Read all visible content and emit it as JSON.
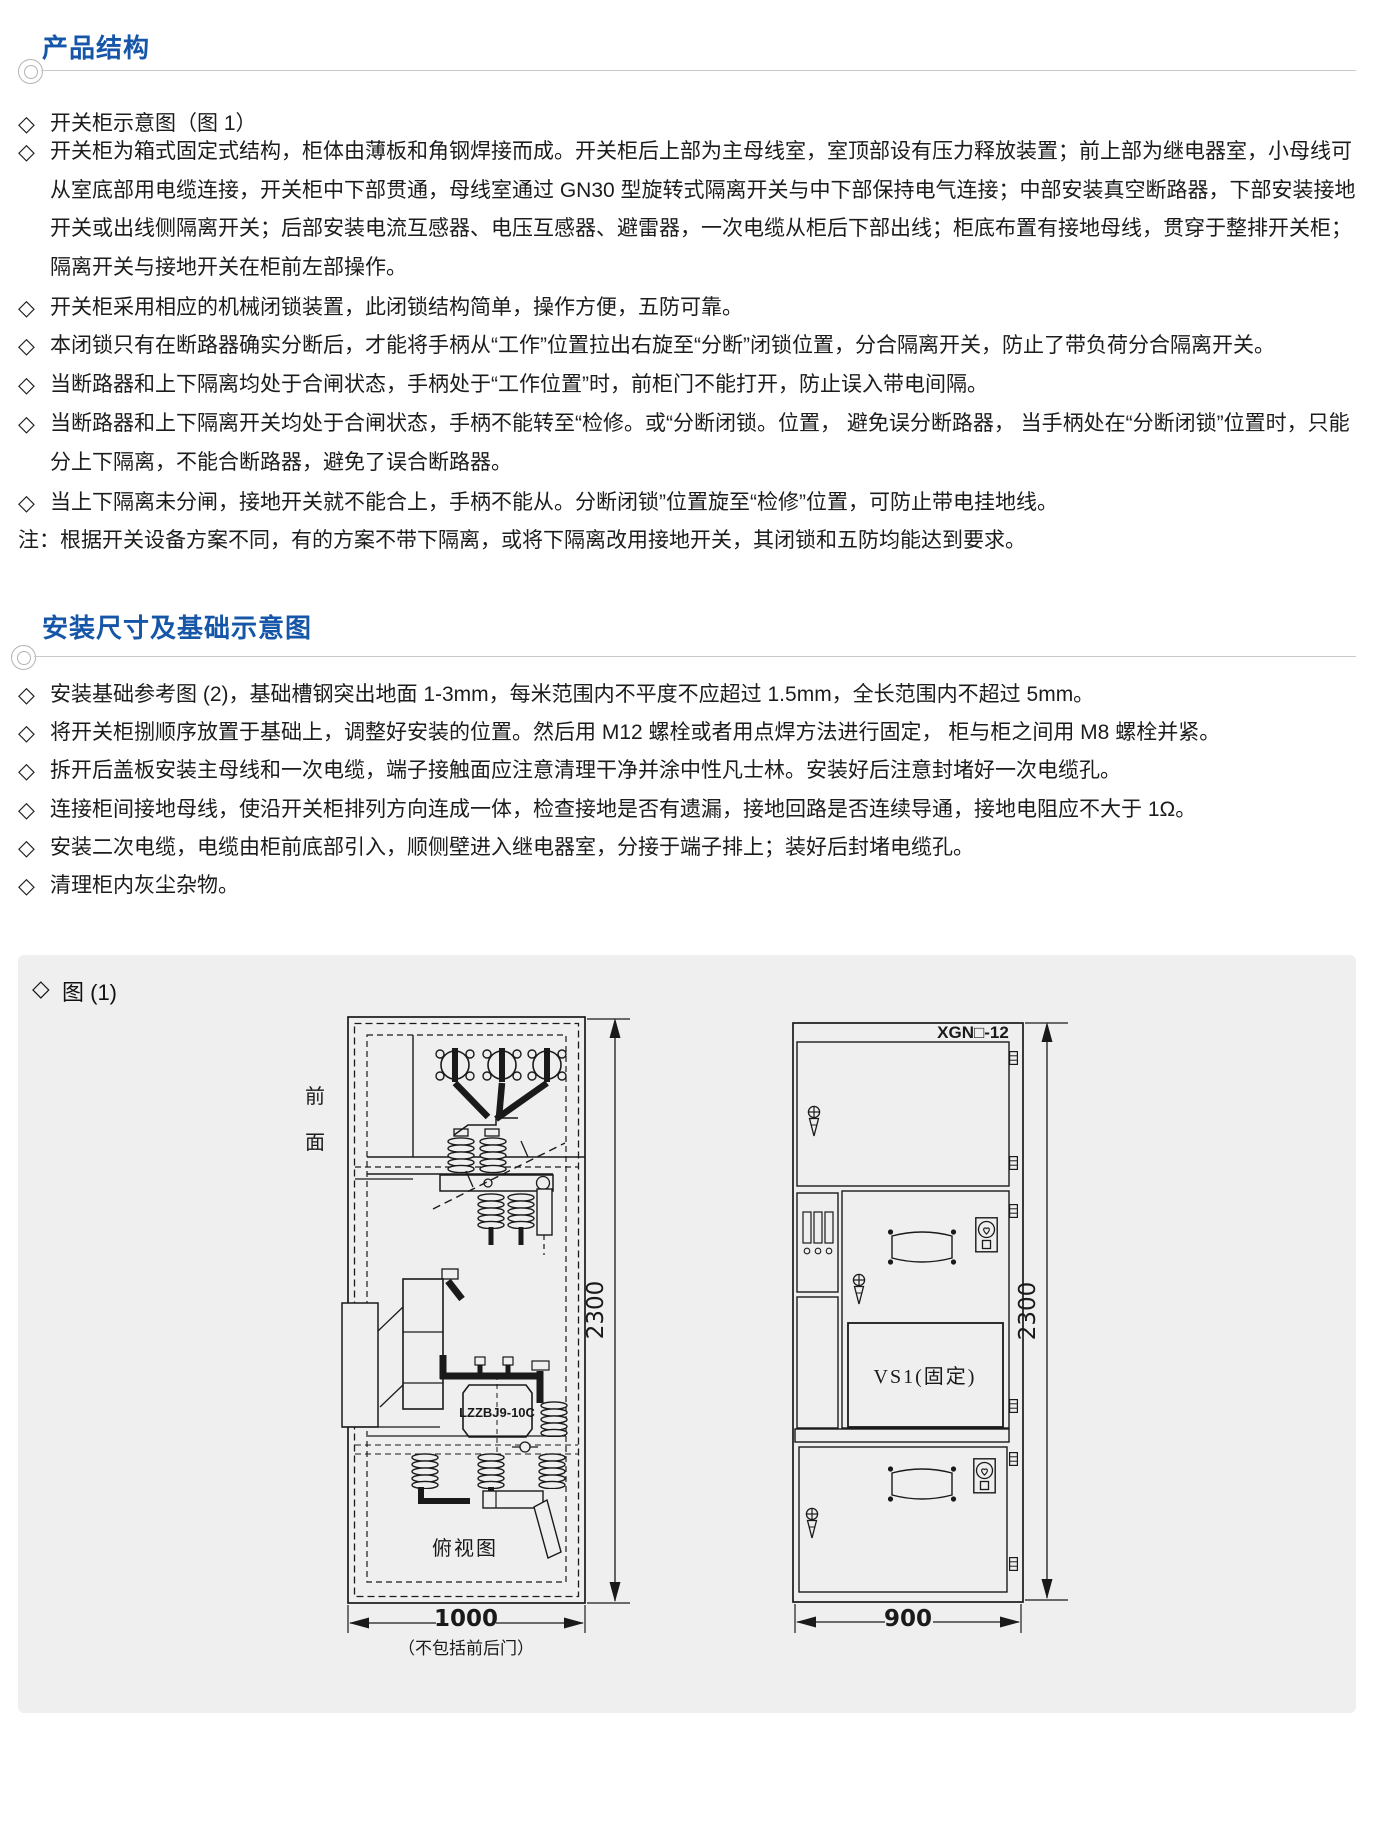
{
  "colors": {
    "accent": "#1656a8",
    "panel_bg": "#efefef",
    "rule": "#c9c9c9",
    "ink": "#1c1c1c"
  },
  "marks": {
    "diamond": "◇"
  },
  "section_product": {
    "title": "产品结构",
    "items": [
      "开关柜示意图（图 1）",
      "开关柜为箱式固定式结构，柜体由薄板和角钢焊接而成。开关柜后上部为主母线室，室顶部设有压力释放装置；前上部为继电器室，小母线可从室底部用电缆连接，开关柜中下部贯通，母线室通过 GN30 型旋转式隔离开关与中下部保持电气连接；中部安装真空断路器，下部安装接地开关或出线侧隔离开关；后部安装电流互感器、电压互感器、避雷器，一次电缆从柜后下部出线；柜底布置有接地母线，贯穿于整排开关柜；隔离开关与接地开关在柜前左部操作。",
      "开关柜采用相应的机械闭锁装置，此闭锁结构简单，操作方便，五防可靠。",
      "本闭锁只有在断路器确实分断后，才能将手柄从“工作”位置拉出右旋至“分断”闭锁位置，分合隔离开关，防止了带负荷分合隔离开关。",
      "当断路器和上下隔离均处于合闸状态，手柄处于“工作位置”时，前柜门不能打开，防止误入带电间隔。",
      "当断路器和上下隔离开关均处于合闸状态，手柄不能转至“检修。或“分断闭锁。位置， 避免误分断路器， 当手柄处在“分断闭锁”位置时，只能分上下隔离，不能合断路器，避免了误合断路器。",
      "当上下隔离未分闸，接地开关就不能合上，手柄不能从。分断闭锁”位置旋至“检修”位置，可防止带电挂地线。"
    ],
    "note": "注：根据开关设备方案不同，有的方案不带下隔离，或将下隔离改用接地开关，其闭锁和五防均能达到要求。"
  },
  "section_install": {
    "title": "安装尺寸及基础示意图",
    "items": [
      "安装基础参考图 (2)，基础槽钢突出地面 1-3mm，每米范围内不平度不应超过 1.5mm，全长范围内不超过 5mm。",
      "将开关柜捌顺序放置于基础上，调整好安装的位置。然后用 M12 螺栓或者用点焊方法进行固定， 柜与柜之间用 M8 螺栓并紧。",
      "拆开后盖板安装主母线和一次电缆，端子接触面应注意清理干净并涂中性凡士林。安装好后注意封堵好一次电缆孔。",
      "连接柜间接地母线，使沿开关柜排列方向连成一体，检查接地是否有遗漏，接地回路是否连续导通，接地电阻应不大于 1Ω。",
      "安装二次电缆，电缆由柜前底部引入，顺侧壁进入继电器室，分接于端子排上；装好后封堵电缆孔。",
      "清理柜内灰尘杂物。"
    ]
  },
  "figure": {
    "label": "图 (1)",
    "side_view": {
      "front_label_top": "前",
      "front_label_bottom": "面",
      "ct_label": "LZZBJ9-10C",
      "top_view_label": "俯视图",
      "height_dim": "2300",
      "width_dim": "1000",
      "width_note": "（不包括前后门）"
    },
    "front_view": {
      "model_label": "XGN□-12",
      "breaker_label": "VS1(固定)",
      "height_dim": "2300",
      "width_dim": "900"
    }
  }
}
